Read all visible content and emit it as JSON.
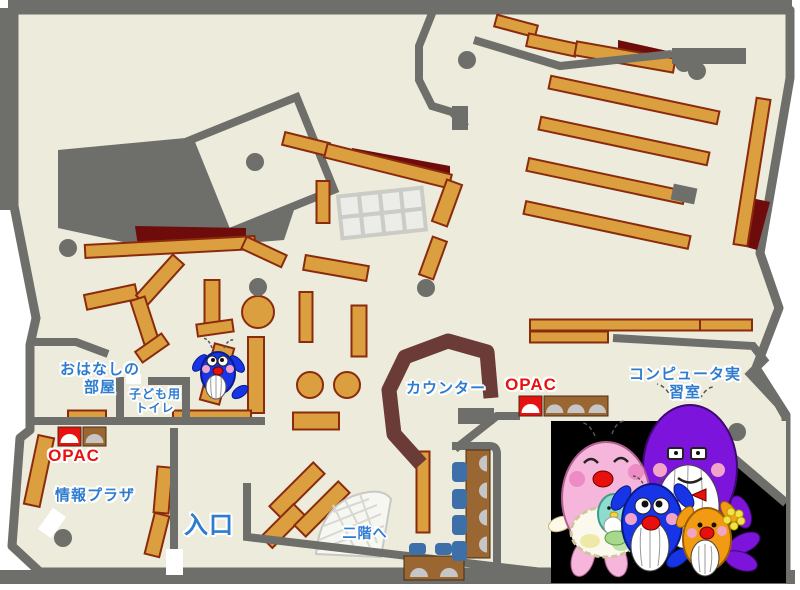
{
  "page": {
    "title": "library-floor-map"
  },
  "labels": [
    {
      "id": "storytelling-room",
      "text": "おはなしの\n部屋",
      "x": 100,
      "y": 361,
      "size": 15,
      "color": "#2E7CCF"
    },
    {
      "id": "kids-toilet",
      "text": "子ども用\nトイレ",
      "x": 155,
      "y": 387,
      "size": 12,
      "color": "#2E7CCF"
    },
    {
      "id": "opac-left",
      "text": "OPAC",
      "x": 74,
      "y": 446,
      "size": 17,
      "color": "#E8120F"
    },
    {
      "id": "info-plaza",
      "text": "情報プラザ",
      "x": 95,
      "y": 487,
      "size": 15,
      "color": "#2E7CCF"
    },
    {
      "id": "entrance",
      "text": "入口",
      "x": 209,
      "y": 512,
      "size": 24,
      "color": "#2E7CCF"
    },
    {
      "id": "counter",
      "text": "カウンター",
      "x": 446,
      "y": 380,
      "size": 15,
      "color": "#2E7CCF"
    },
    {
      "id": "opac-right",
      "text": "OPAC",
      "x": 531,
      "y": 375,
      "size": 17,
      "color": "#E8120F"
    },
    {
      "id": "stairs",
      "text": "二階へ",
      "x": 365,
      "y": 525,
      "size": 14,
      "color": "#2E7CCF"
    },
    {
      "id": "computer-room",
      "text": "コンピュータ実習室",
      "x": 685,
      "y": 366,
      "size": 15,
      "color": "#2E7CCF"
    }
  ],
  "map": {
    "colors": {
      "floor": "#EDEBDC",
      "wall": "#6E6E6A",
      "dark_red": "#6E0B0B",
      "shelf": "#DC9F40",
      "shelf_border": "#8A2B0D",
      "counter": "#6B3B38",
      "chair": "#3D6FA8",
      "machine_brown": "#9A6733",
      "machine_red": "#E81111",
      "dome_gray": "#C6C6C6",
      "photo_bg": "#000000"
    },
    "floor_outline": "14,10 790,10 790,78 760,253 779,308 756,368 786,415 786,572 40,572 12,546 20,438 30,430 30,345 36,318 14,206",
    "frame_bars": [
      [
        8,
        0,
        784,
        11
      ],
      [
        0,
        8,
        15,
        202
      ],
      [
        0,
        570,
        795,
        14
      ]
    ],
    "staff_area": "58,150 228,134 302,186 284,240 160,250 58,228",
    "tilted_room": {
      "x": 262,
      "y": 165,
      "w": 115,
      "h": 100,
      "r": -22
    },
    "dark_red_areas": [
      "352,148 450,166 450,180 352,160",
      "618,40 672,52 672,62 618,50",
      "742,196 770,202 757,250 736,244",
      "135,226 246,228 246,247 138,246"
    ],
    "grid_table": {
      "x": 340,
      "y": 192,
      "cols": 4,
      "rows": 2,
      "cell": 21,
      "r": -6
    },
    "shelves": [
      [
        634,
        100,
        172,
        13,
        12
      ],
      [
        624,
        141,
        172,
        13,
        12
      ],
      [
        606,
        181,
        160,
        13,
        12
      ],
      [
        607,
        225,
        168,
        13,
        12
      ],
      [
        752,
        172,
        14,
        148,
        9
      ],
      [
        516,
        26,
        42,
        12,
        15
      ],
      [
        552,
        45,
        50,
        13,
        12
      ],
      [
        625,
        57,
        100,
        14,
        10
      ],
      [
        306,
        144,
        46,
        13,
        14
      ],
      [
        388,
        166,
        128,
        14,
        14
      ],
      [
        323,
        202,
        13,
        42,
        0
      ],
      [
        447,
        203,
        16,
        44,
        20
      ],
      [
        433,
        258,
        15,
        40,
        20
      ],
      [
        336,
        268,
        64,
        15,
        10
      ],
      [
        306,
        317,
        13,
        50,
        0
      ],
      [
        359,
        331,
        15,
        51,
        0
      ],
      [
        111,
        297,
        52,
        15,
        -12
      ],
      [
        160,
        280,
        55,
        15,
        -48
      ],
      [
        146,
        325,
        55,
        15,
        72
      ],
      [
        212,
        306,
        15,
        52,
        0
      ],
      [
        215,
        328,
        36,
        12,
        -8
      ],
      [
        152,
        348,
        32,
        13,
        -35
      ],
      [
        217,
        374,
        20,
        58,
        15
      ],
      [
        256,
        375,
        16,
        76,
        0
      ],
      [
        87,
        417,
        38,
        13,
        0
      ],
      [
        212,
        417,
        78,
        13,
        0
      ],
      [
        39,
        471,
        16,
        70,
        12
      ],
      [
        163,
        490,
        15,
        46,
        5
      ],
      [
        157,
        535,
        15,
        42,
        14
      ],
      [
        297,
        490,
        62,
        16,
        -45
      ],
      [
        283,
        526,
        46,
        16,
        -45
      ],
      [
        322,
        509,
        62,
        16,
        -45
      ],
      [
        423,
        492,
        13,
        81,
        0
      ],
      [
        316,
        421,
        46,
        17,
        0
      ],
      [
        615,
        325,
        170,
        11,
        0
      ],
      [
        726,
        325,
        52,
        11,
        0
      ],
      [
        569,
        337,
        78,
        11,
        0
      ],
      [
        170,
        247,
        170,
        13,
        -3
      ],
      [
        264,
        252,
        44,
        13,
        25
      ]
    ],
    "round_tables": [
      [
        258,
        312,
        16
      ],
      [
        310,
        385,
        13
      ],
      [
        347,
        385,
        13
      ]
    ],
    "gray_blocks": [
      [
        672,
        186,
        24,
        16,
        12
      ],
      [
        452,
        106,
        16,
        24,
        0
      ],
      [
        672,
        48,
        74,
        16,
        0
      ],
      [
        458,
        408,
        36,
        16,
        0
      ]
    ],
    "counter_path": "M421,464 L394,434 L389,390 L405,357 L448,341 L487,352 L491,398",
    "walls": [
      "M433,11 L419,46 L419,80 L432,106 L452,112 L466,127",
      "M474,40 L560,66 L672,54",
      "M613,338 L753,346 L764,360 L750,374 L778,404 L786,418",
      "M520,416 L497,416 L455,449",
      "M452,446 L490,446 Q497,446 497,454 L497,564 Q497,574 487,576 L458,576",
      "M28,421 L265,421",
      "M30,342 L76,342 L108,354",
      "M120,377 L120,421",
      "M148,381 L190,381",
      "M186,381 L186,421",
      "M174,428 L174,552",
      "M247,483 L247,537 L560,574"
    ],
    "doors": [
      [
        44,
        510,
        16,
        26,
        35
      ],
      [
        166,
        549,
        17,
        26,
        0
      ],
      [
        126,
        374,
        15,
        10,
        0
      ]
    ],
    "machines": [
      {
        "x": 58,
        "y": 427,
        "w": 23,
        "h": 19,
        "body": "#E81111",
        "dome": "#FFFFFF",
        "domes": 1
      },
      {
        "x": 83,
        "y": 427,
        "w": 23,
        "h": 19,
        "body": "#9A6733",
        "dome": "#C6C6C6",
        "domes": 1
      },
      {
        "x": 519,
        "y": 396,
        "w": 23,
        "h": 20,
        "body": "#E81111",
        "dome": "#FFFFFF",
        "domes": 1
      },
      {
        "x": 544,
        "y": 396,
        "w": 64,
        "h": 20,
        "body": "#9A6733",
        "dome": "#C6C6C6",
        "domes": 3
      },
      {
        "x": 466,
        "y": 450,
        "w": 24,
        "h": 108,
        "body": "#9A6733",
        "dome": "#C6C6C6",
        "domes": 4,
        "vertical": true
      },
      {
        "x": 404,
        "y": 556,
        "w": 60,
        "h": 24,
        "body": "#9A6733",
        "dome": "#C6C6C6",
        "domes": 2
      }
    ],
    "chairs": [
      [
        452,
        462,
        15,
        20
      ],
      [
        452,
        489,
        15,
        20
      ],
      [
        452,
        515,
        15,
        20
      ],
      [
        452,
        541,
        15,
        20
      ],
      [
        409,
        543,
        17,
        12
      ],
      [
        435,
        543,
        17,
        12
      ]
    ],
    "pillars": [
      [
        68,
        248
      ],
      [
        255,
        162
      ],
      [
        426,
        288
      ],
      [
        467,
        60
      ],
      [
        684,
        63
      ],
      [
        697,
        71
      ],
      [
        63,
        538
      ],
      [
        258,
        287
      ],
      [
        737,
        432
      ]
    ],
    "photo_wedge": "690,421 786,421 786,503",
    "photo_wedge_wall": "M690,421 L786,503"
  },
  "photo": {
    "background": "#000000",
    "characters": [
      "mother-whale-pink",
      "baby-whale-teal",
      "father-whale-purple",
      "kid-whale-blue",
      "kid-whale-orange"
    ]
  }
}
